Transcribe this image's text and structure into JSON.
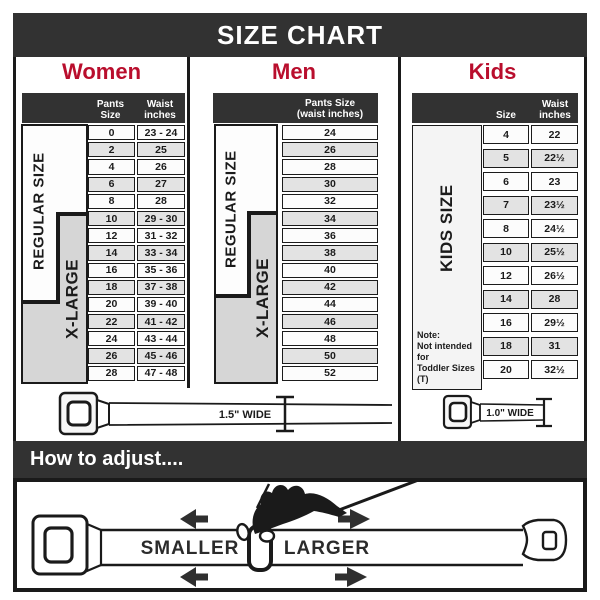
{
  "title": "SIZE CHART",
  "colors": {
    "accent_red": "#b90e2d",
    "dark_bar": "#323232",
    "row_alt": "#e3e3e3"
  },
  "sections": {
    "women": {
      "label": "Women",
      "size_labels": {
        "regular": "REGULAR SIZE",
        "xlarge": "X-LARGE"
      },
      "columns": [
        "Pants Size",
        "Waist inches"
      ],
      "rows": [
        [
          "0",
          "23 - 24"
        ],
        [
          "2",
          "25"
        ],
        [
          "4",
          "26"
        ],
        [
          "6",
          "27"
        ],
        [
          "8",
          "28"
        ],
        [
          "10",
          "29 - 30"
        ],
        [
          "12",
          "31 - 32"
        ],
        [
          "14",
          "33 - 34"
        ],
        [
          "16",
          "35 - 36"
        ],
        [
          "18",
          "37 - 38"
        ],
        [
          "20",
          "39 - 40"
        ],
        [
          "22",
          "41 - 42"
        ],
        [
          "24",
          "43 - 44"
        ],
        [
          "26",
          "45 - 46"
        ],
        [
          "28",
          "47 - 48"
        ]
      ]
    },
    "men": {
      "label": "Men",
      "size_labels": {
        "regular": "REGULAR SIZE",
        "xlarge": "X-LARGE"
      },
      "columns": [
        "Pants Size",
        "(waist inches)"
      ],
      "rows": [
        "24",
        "26",
        "28",
        "30",
        "32",
        "34",
        "36",
        "38",
        "40",
        "42",
        "44",
        "46",
        "48",
        "50",
        "52"
      ]
    },
    "kids": {
      "label": "Kids",
      "size_label": "KIDS SIZE",
      "columns": [
        "Size",
        "Waist inches"
      ],
      "rows": [
        [
          "4",
          "22"
        ],
        [
          "5",
          "22½"
        ],
        [
          "6",
          "23"
        ],
        [
          "7",
          "23½"
        ],
        [
          "8",
          "24½"
        ],
        [
          "10",
          "25½"
        ],
        [
          "12",
          "26½"
        ],
        [
          "14",
          "28"
        ],
        [
          "16",
          "29½"
        ],
        [
          "18",
          "31"
        ],
        [
          "20",
          "32½"
        ]
      ],
      "note": [
        "Note:",
        "Not intended for",
        "Toddler Sizes (T)"
      ]
    }
  },
  "belts": {
    "adult_width": "1.5\" WIDE",
    "kids_width": "1.0\" WIDE"
  },
  "adjust": {
    "heading": "How to adjust....",
    "smaller": "SMALLER",
    "larger": "LARGER"
  }
}
